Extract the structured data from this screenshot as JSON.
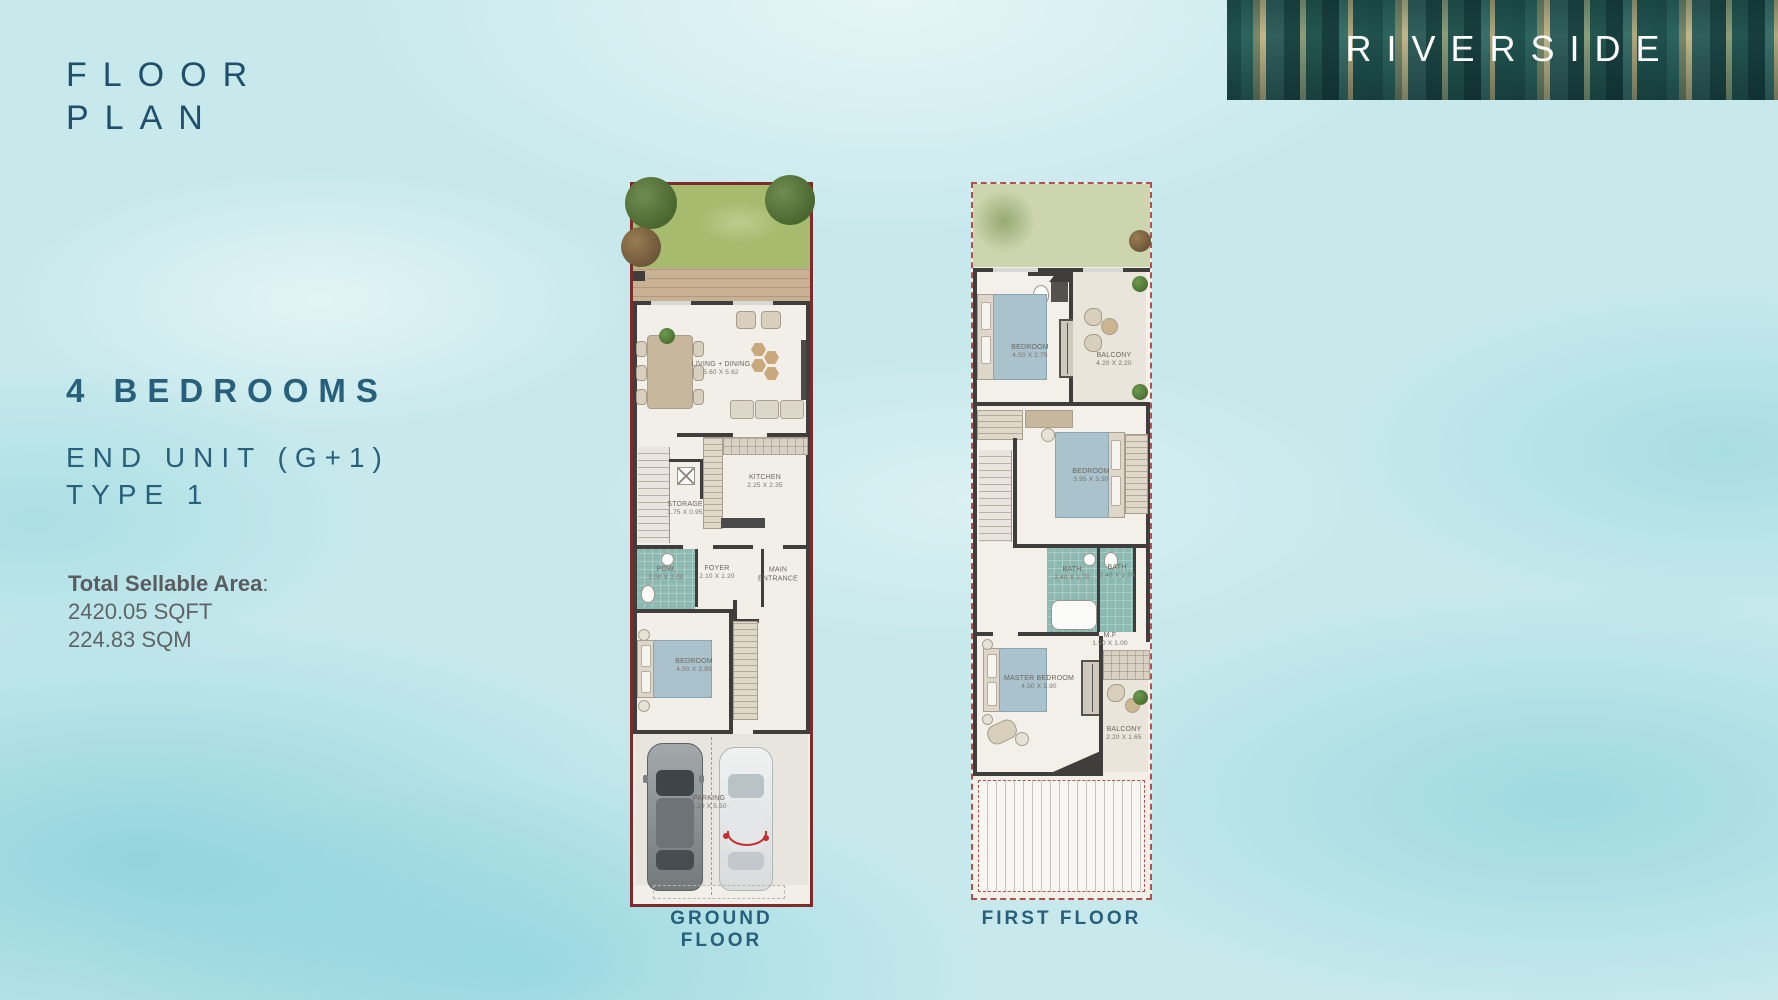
{
  "page": {
    "title_line1": "FLOOR",
    "title_line2": "PLAN",
    "brand": "RIVERSIDE",
    "bedrooms_heading": "4 BEDROOMS",
    "unit_line1": "END UNIT (G+1)",
    "unit_line2": "TYPE 1",
    "area_label": "Total Sellable Area",
    "area_colon": ":",
    "area_sqft": "2420.05 SQFT",
    "area_sqm": "224.83 SQM",
    "colors": {
      "heading_teal": "#28607c",
      "banner_text": "#ffffff",
      "plan_border_solid": "#7d2b2b",
      "plan_border_dashed": "#b05050",
      "background_aqua": "#c7e9ec"
    }
  },
  "ground_floor": {
    "caption": "GROUND FLOOR",
    "rooms": [
      {
        "name": "LIVING + DINING",
        "dims": "5.60 X 5.62"
      },
      {
        "name": "KITCHEN",
        "dims": "2.25 X 2.35"
      },
      {
        "name": "STORAGE",
        "dims": "1.75 X 0.95"
      },
      {
        "name": "POW.",
        "dims": "2.00 X 2.00"
      },
      {
        "name": "FOYER",
        "dims": "2.10 X 1.20"
      },
      {
        "name": "MAIN ENTRANCE",
        "dims": ""
      },
      {
        "name": "BEDROOM",
        "dims": "4.50 X 3.90"
      },
      {
        "name": "PARKING",
        "dims": "6.20 X 5.50"
      }
    ]
  },
  "first_floor": {
    "caption": "FIRST FLOOR",
    "rooms": [
      {
        "name": "BEDROOM",
        "dims": "4.50 X 2.75"
      },
      {
        "name": "BALCONY",
        "dims": "4.20 X 2.20"
      },
      {
        "name": "BEDROOM",
        "dims": "3.95 X 3.30"
      },
      {
        "name": "BATH",
        "dims": "2.40 X 1.70"
      },
      {
        "name": "BATH",
        "dims": "2.40 X 1.20"
      },
      {
        "name": "M.F",
        "dims": "1.90 X 1.00"
      },
      {
        "name": "MASTER BEDROOM",
        "dims": "4.50 X 3.90"
      },
      {
        "name": "BALCONY",
        "dims": "2.20 X 1.65"
      }
    ]
  }
}
